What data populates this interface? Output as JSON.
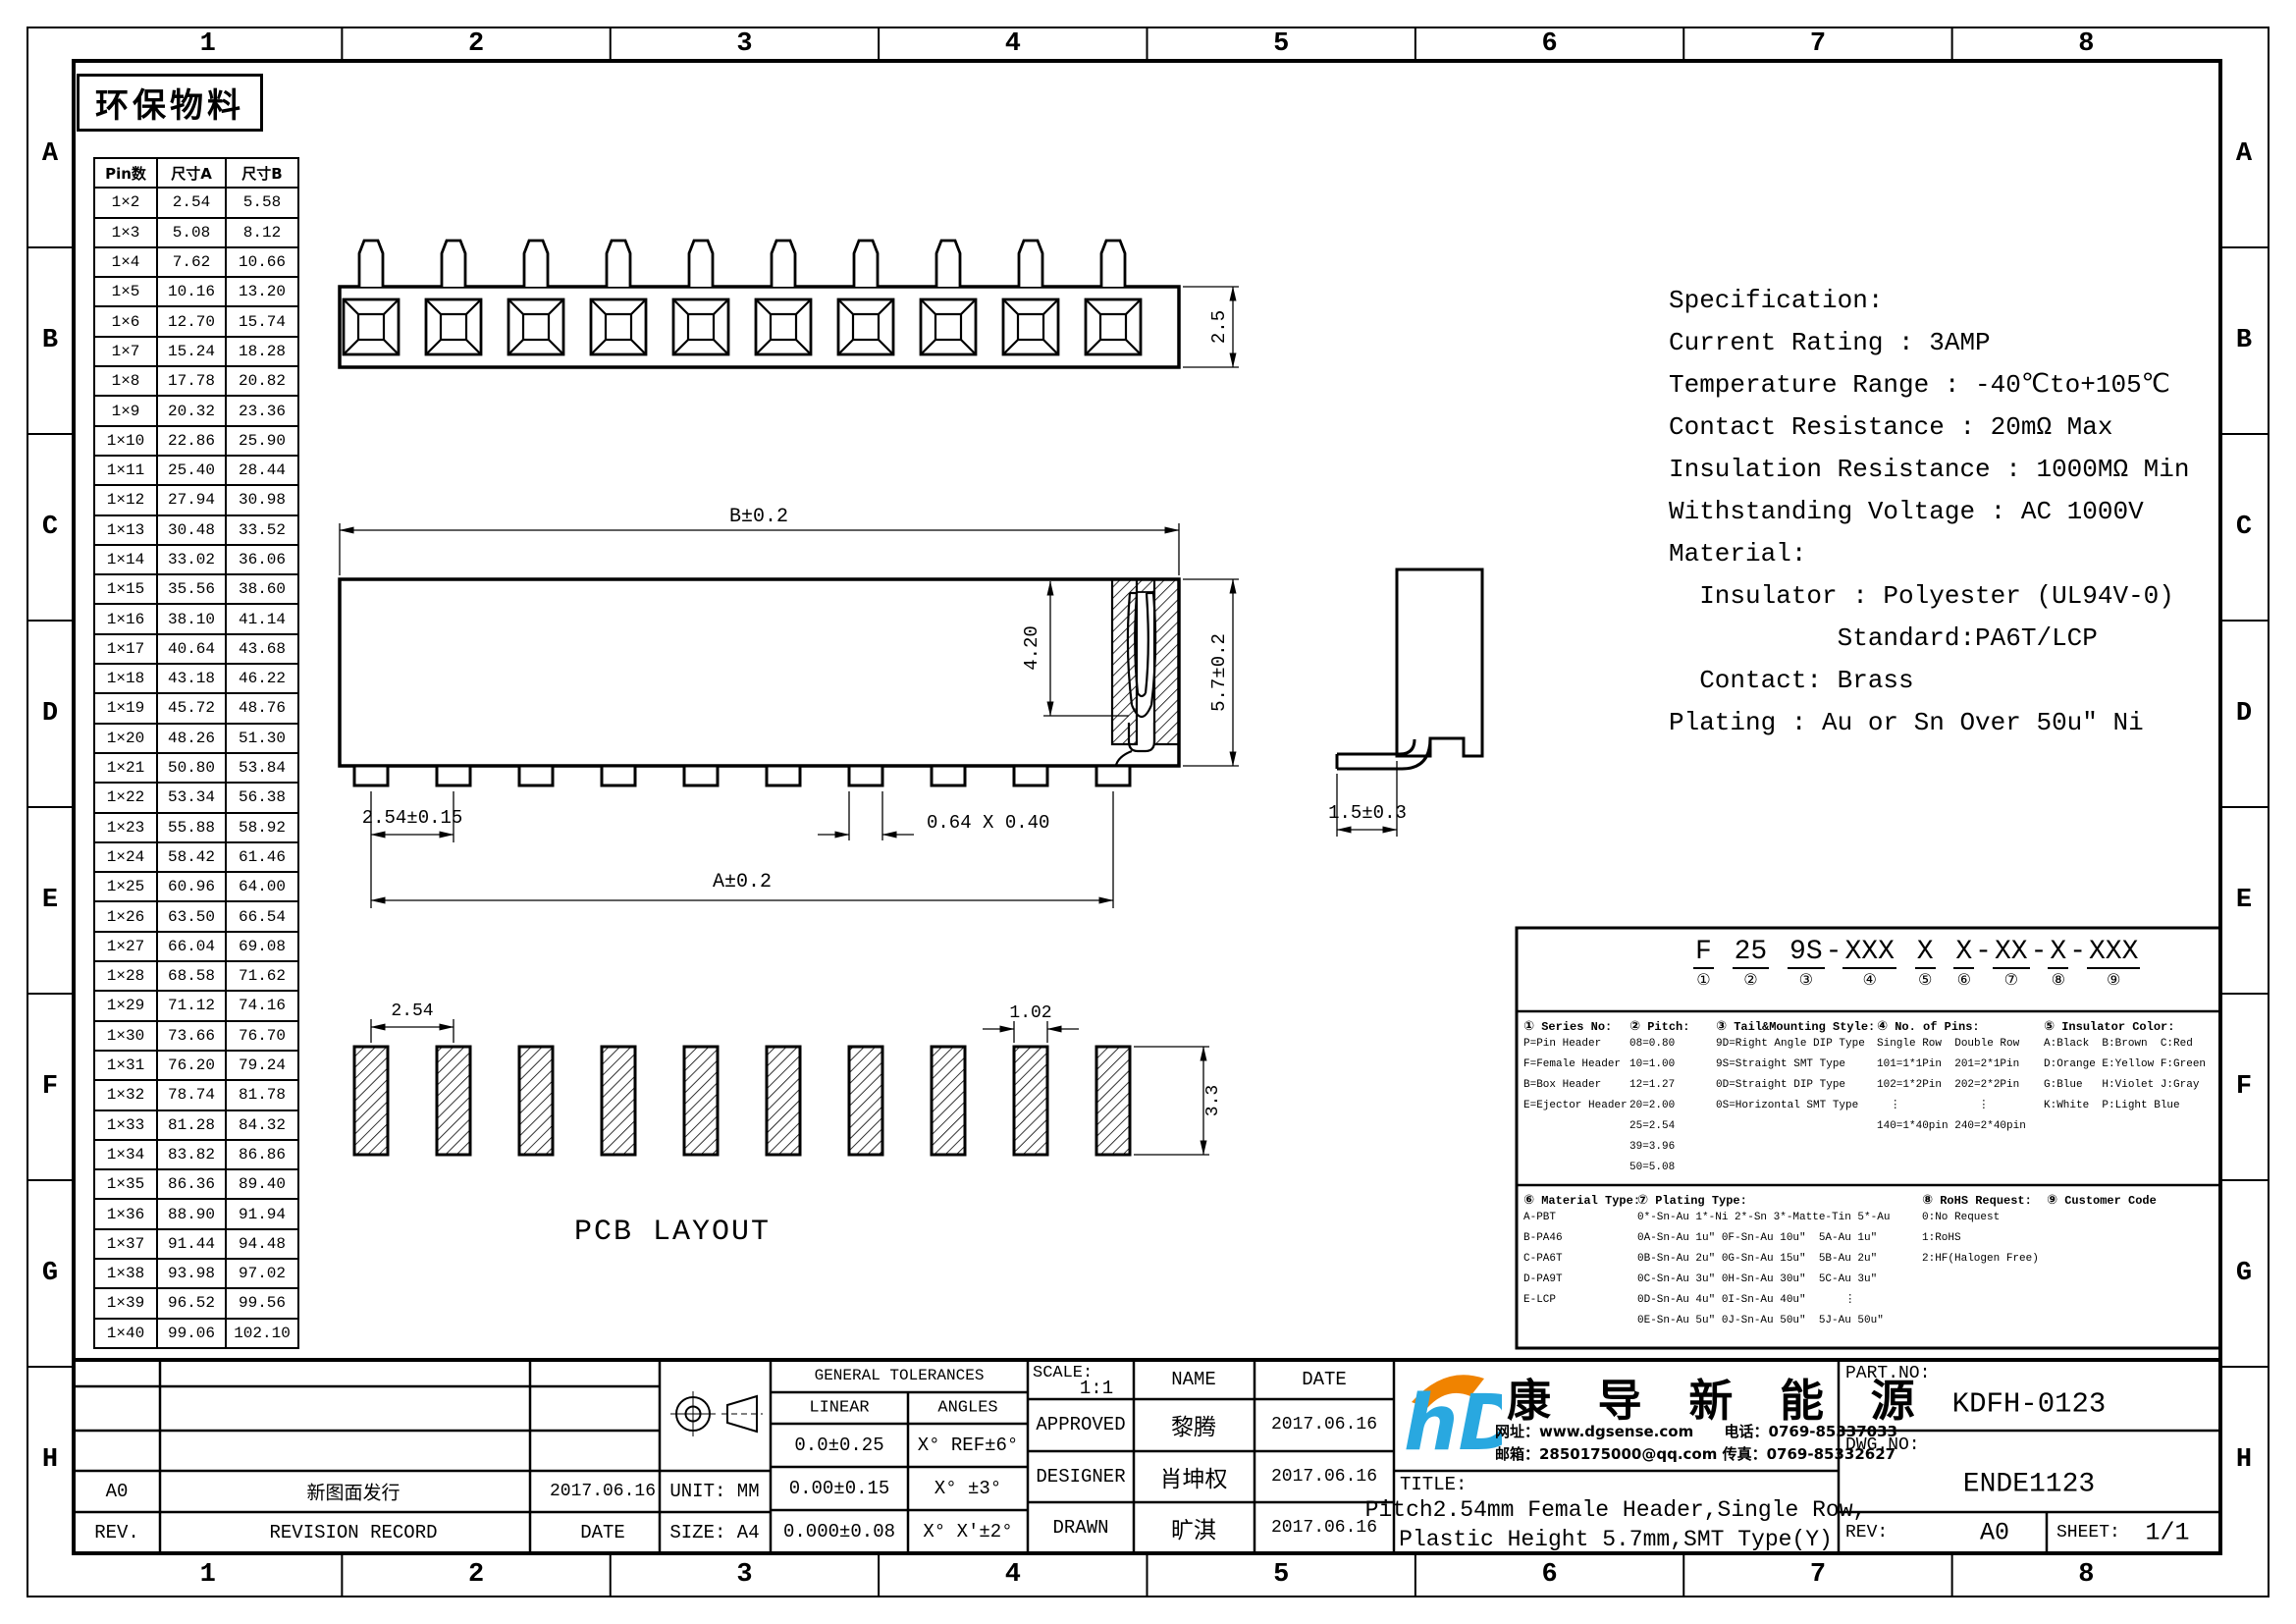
{
  "sheet": {
    "zone_columns": [
      "1",
      "2",
      "3",
      "4",
      "5",
      "6",
      "7",
      "8"
    ],
    "zone_rows": [
      "A",
      "B",
      "C",
      "D",
      "E",
      "F",
      "G",
      "H"
    ],
    "stamp": "环保物料"
  },
  "pin_table": {
    "headers": [
      "Pin数",
      "尺寸A",
      "尺寸B"
    ],
    "rows": [
      [
        "1×2",
        "2.54",
        "5.58"
      ],
      [
        "1×3",
        "5.08",
        "8.12"
      ],
      [
        "1×4",
        "7.62",
        "10.66"
      ],
      [
        "1×5",
        "10.16",
        "13.20"
      ],
      [
        "1×6",
        "12.70",
        "15.74"
      ],
      [
        "1×7",
        "15.24",
        "18.28"
      ],
      [
        "1×8",
        "17.78",
        "20.82"
      ],
      [
        "1×9",
        "20.32",
        "23.36"
      ],
      [
        "1×10",
        "22.86",
        "25.90"
      ],
      [
        "1×11",
        "25.40",
        "28.44"
      ],
      [
        "1×12",
        "27.94",
        "30.98"
      ],
      [
        "1×13",
        "30.48",
        "33.52"
      ],
      [
        "1×14",
        "33.02",
        "36.06"
      ],
      [
        "1×15",
        "35.56",
        "38.60"
      ],
      [
        "1×16",
        "38.10",
        "41.14"
      ],
      [
        "1×17",
        "40.64",
        "43.68"
      ],
      [
        "1×18",
        "43.18",
        "46.22"
      ],
      [
        "1×19",
        "45.72",
        "48.76"
      ],
      [
        "1×20",
        "48.26",
        "51.30"
      ],
      [
        "1×21",
        "50.80",
        "53.84"
      ],
      [
        "1×22",
        "53.34",
        "56.38"
      ],
      [
        "1×23",
        "55.88",
        "58.92"
      ],
      [
        "1×24",
        "58.42",
        "61.46"
      ],
      [
        "1×25",
        "60.96",
        "64.00"
      ],
      [
        "1×26",
        "63.50",
        "66.54"
      ],
      [
        "1×27",
        "66.04",
        "69.08"
      ],
      [
        "1×28",
        "68.58",
        "71.62"
      ],
      [
        "1×29",
        "71.12",
        "74.16"
      ],
      [
        "1×30",
        "73.66",
        "76.70"
      ],
      [
        "1×31",
        "76.20",
        "79.24"
      ],
      [
        "1×32",
        "78.74",
        "81.78"
      ],
      [
        "1×33",
        "81.28",
        "84.32"
      ],
      [
        "1×34",
        "83.82",
        "86.86"
      ],
      [
        "1×35",
        "86.36",
        "89.40"
      ],
      [
        "1×36",
        "88.90",
        "91.94"
      ],
      [
        "1×37",
        "91.44",
        "94.48"
      ],
      [
        "1×38",
        "93.98",
        "97.02"
      ],
      [
        "1×39",
        "96.52",
        "99.56"
      ],
      [
        "1×40",
        "99.06",
        "102.10"
      ]
    ]
  },
  "views": {
    "positions": 10,
    "top_view": {
      "height": "2.5"
    },
    "front_view": {
      "b": "B±0.2",
      "a": "A±0.2",
      "pitch": "2.54±0.15",
      "pad": "0.64 X 0.40",
      "depth": "4.20",
      "total": "5.7±0.2"
    },
    "side_view": {
      "lead": "1.5±0.3"
    },
    "pcb": {
      "label": "PCB LAYOUT",
      "pitch": "2.54",
      "pad_w": "1.02",
      "pad_h": "3.3"
    }
  },
  "specification": {
    "lines": [
      "Specification:",
      "Current Rating : 3AMP",
      "Temperature Range : -40℃to+105℃",
      "Contact Resistance : 20mΩ Max",
      "Insulation Resistance : 1000MΩ Min",
      "Withstanding Voltage : AC 1000V",
      "Material:",
      "  Insulator : Polyester (UL94V-0)",
      "           Standard:PA6T/LCP",
      "  Contact: Brass",
      "Plating : Au or Sn Over 50u″ Ni"
    ]
  },
  "part_code": {
    "segments": [
      {
        "text": "F",
        "mark": "①",
        "sep": ""
      },
      {
        "text": "25",
        "mark": "②",
        "sep": " "
      },
      {
        "text": "9S",
        "mark": "③",
        "sep": " "
      },
      {
        "text": "XXX",
        "mark": "④",
        "sep": "-"
      },
      {
        "text": "X",
        "mark": "⑤",
        "sep": " "
      },
      {
        "text": "X",
        "mark": "⑥",
        "sep": " "
      },
      {
        "text": "XX",
        "mark": "⑦",
        "sep": "-"
      },
      {
        "text": "X",
        "mark": "⑧",
        "sep": "-"
      },
      {
        "text": "XXX",
        "mark": "⑨",
        "sep": "-"
      }
    ],
    "sections_top": [
      {
        "mark": "①",
        "title": "Series No:",
        "lines": [
          "P=Pin Header",
          "F=Female Header",
          "B=Box Header",
          "E=Ejector Header"
        ]
      },
      {
        "mark": "②",
        "title": "Pitch:",
        "lines": [
          "08=0.80",
          "10=1.00",
          "12=1.27",
          "20=2.00",
          "25=2.54",
          "39=3.96",
          "50=5.08"
        ]
      },
      {
        "mark": "③",
        "title": "Tail&Mounting Style:",
        "lines": [
          "9D=Right Angle DIP Type",
          "9S=Straight SMT Type",
          "0D=Straight DIP Type",
          "0S=Horizontal SMT Type"
        ]
      },
      {
        "mark": "④",
        "title": "No. of Pins:",
        "lines": [
          "Single Row  Double Row",
          "101=1*1Pin  201=2*1Pin",
          "102=1*2Pin  202=2*2Pin",
          "  ⋮            ⋮",
          "140=1*40pin 240=2*40pin"
        ]
      },
      {
        "mark": "⑤",
        "title": "Insulator Color:",
        "lines": [
          "A:Black  B:Brown  C:Red",
          "D:Orange E:Yellow F:Green",
          "G:Blue   H:Violet J:Gray",
          "K:White  P:Light Blue"
        ]
      }
    ],
    "sections_bottom": [
      {
        "mark": "⑥",
        "title": "Material Type:",
        "lines": [
          "A-PBT",
          "B-PA46",
          "C-PA6T",
          "D-PA9T",
          "E-LCP"
        ]
      },
      {
        "mark": "⑦",
        "title": "Plating Type:",
        "lines": [
          "0*-Sn-Au 1*-Ni 2*-Sn 3*-Matte-Tin 5*-Au",
          "0A-Sn-Au 1u″ 0F-Sn-Au 10u″  5A-Au 1u″",
          "0B-Sn-Au 2u″ 0G-Sn-Au 15u″  5B-Au 2u″",
          "0C-Sn-Au 3u″ 0H-Sn-Au 30u″  5C-Au 3u″",
          "0D-Sn-Au 4u″ 0I-Sn-Au 40u″      ⋮",
          "0E-Sn-Au 5u″ 0J-Sn-Au 50u″  5J-Au 50u″"
        ]
      },
      {
        "mark": "⑧",
        "title": "RoHS Request:",
        "lines": [
          "0:No Request",
          "1:RoHS",
          "2:HF(Halogen Free)"
        ]
      },
      {
        "mark": "⑨",
        "title": "Customer Code",
        "lines": []
      }
    ]
  },
  "title_block": {
    "revision": {
      "rev_header": "REV.",
      "record_header": "REVISION RECORD",
      "date_header": "DATE",
      "rows": [
        {
          "rev": "A0",
          "record": "新图面发行",
          "date": "2017.06.16"
        }
      ]
    },
    "unit_label": "UNIT:",
    "unit": "MM",
    "size_label": "SIZE:",
    "size": "A4",
    "tolerances": {
      "header": "GENERAL TOLERANCES",
      "linear_header": "LINEAR",
      "angles_header": "ANGLES",
      "linear": [
        "0.0±0.25",
        "0.00±0.15",
        "0.000±0.08"
      ],
      "angles": [
        "X° REF±6°",
        "X° ±3°",
        "X° X'±2°"
      ]
    },
    "scale_label": "SCALE:",
    "scale": "1:1",
    "name_header": "NAME",
    "date_header": "DATE",
    "signoff": [
      {
        "role": "APPROVED",
        "name": "黎腾",
        "date": "2017.06.16"
      },
      {
        "role": "DESIGNER",
        "name": "肖坤权",
        "date": "2017.06.16"
      },
      {
        "role": "DRAWN",
        "name": "旷淇",
        "date": "2017.06.16"
      }
    ],
    "company": {
      "name": "康 导 新 能 源",
      "logo_text": "hD",
      "contact1": "网址：www.dgsense.com      电话：0769-85337033",
      "contact2": "邮箱：2850175000@qq.com 传真：0769-85332627",
      "brand_blue": "#29A8E0",
      "brand_orange": "#F08300"
    },
    "title_label": "TITLE:",
    "title_line1": "Pitch2.54mm Female Header,Single Row,",
    "title_line2": "Plastic Height 5.7mm,SMT Type(Y)",
    "part_no_label": "PART.NO:",
    "part_no": "KDFH-0123",
    "dwg_no_label": "DWG.NO:",
    "dwg_no": "ENDE1123",
    "rev_label": "REV:",
    "rev": "A0",
    "sheet_label": "SHEET:",
    "sheet": "1/1"
  }
}
